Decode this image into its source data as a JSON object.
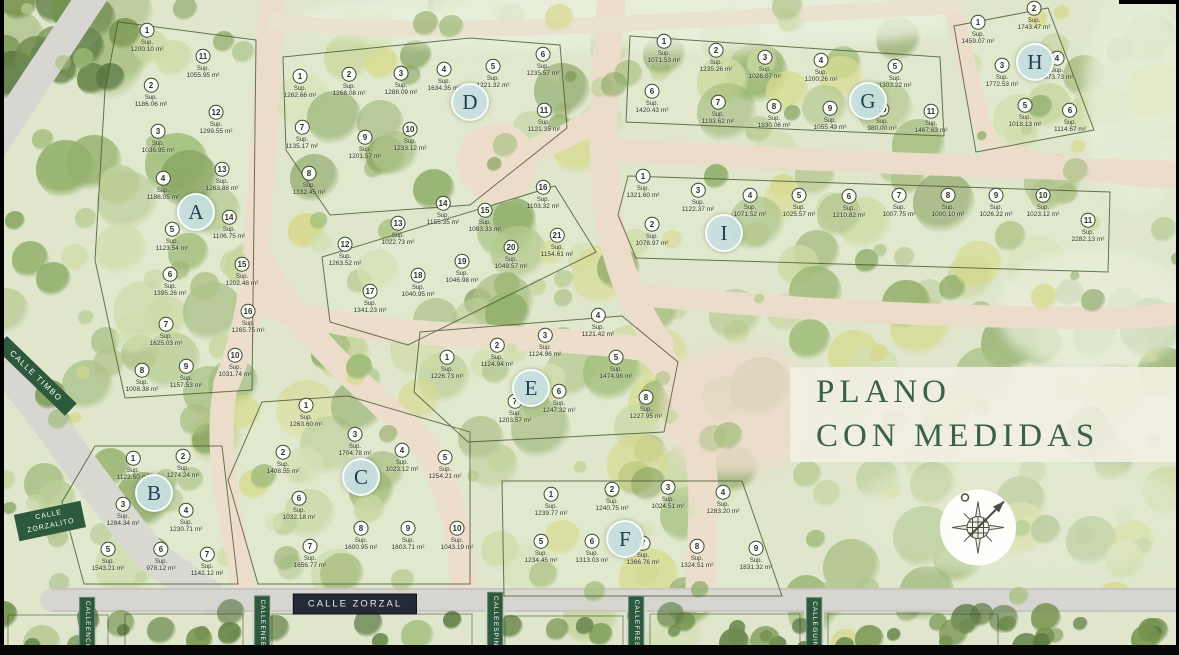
{
  "title": {
    "line1": "PLANO",
    "line2": "CON MEDIDAS"
  },
  "legend": {
    "sup_label": "Sup."
  },
  "colors": {
    "title_green": "#3c6149",
    "street_green": "#2d5a3d",
    "street_dark": "#1a212e",
    "badge_fill": "#c6deDD",
    "road_pink": "#ecdcca",
    "road_gray": "#d8d6d0",
    "forest_base": "#dfe6cc"
  },
  "compass": {
    "icon": "compass-rose"
  },
  "streets": [
    {
      "id": "calle-timbo",
      "label": "CALLE TIMBO",
      "lines": [
        "CALLE TIMBO"
      ],
      "type": "ribbon",
      "x": 36,
      "y": 376,
      "rot": 44
    },
    {
      "id": "calle-zorzalito",
      "label": "CALLE ZORZALITO",
      "lines": [
        "CALLE",
        "ZORZALITO"
      ],
      "type": "ribbon2",
      "x": 50,
      "y": 521,
      "rot": -12
    },
    {
      "id": "calle-zorzal",
      "label": "CALLE ZORZAL",
      "lines": [
        "CALLE ZORZAL"
      ],
      "type": "dark",
      "x": 355,
      "y": 604,
      "rot": 0
    },
    {
      "id": "calle-encina",
      "label": "CALLE ENCINA",
      "lines": [
        "CALLE",
        "ENCINA"
      ],
      "type": "vert",
      "x": 87,
      "y": 629,
      "rot": 0
    },
    {
      "id": "calle-enebro",
      "label": "CALLE ENEBRO",
      "lines": [
        "CALLE",
        "ENEBRO"
      ],
      "type": "vert",
      "x": 262,
      "y": 629,
      "rot": 0
    },
    {
      "id": "calle-espinillo",
      "label": "CALLE ESPINILLO",
      "lines": [
        "CALLE",
        "ESPINILLO"
      ],
      "type": "vert",
      "x": 495,
      "y": 630,
      "rot": 0
    },
    {
      "id": "calle-fresno",
      "label": "CALLE FRESNO",
      "lines": [
        "CALLE",
        "FRESNO"
      ],
      "type": "vert",
      "x": 636,
      "y": 629,
      "rot": 0
    },
    {
      "id": "calle-guindo",
      "label": "CALLE GUINDO",
      "lines": [
        "CALLE",
        "GUINDO"
      ],
      "type": "vert",
      "x": 814,
      "y": 630,
      "rot": 0
    }
  ],
  "blocks": [
    {
      "letter": "A",
      "badge": {
        "x": 196,
        "y": 212
      },
      "lots": [
        {
          "n": 1,
          "area": "1200.10 m²",
          "x": 147,
          "y": 38
        },
        {
          "n": 2,
          "area": "1186.06 m²",
          "x": 151,
          "y": 93
        },
        {
          "n": 3,
          "area": "1036.95 m²",
          "x": 158,
          "y": 139
        },
        {
          "n": 4,
          "area": "1186.05 m²",
          "x": 163,
          "y": 186
        },
        {
          "n": 5,
          "area": "1123.54 m²",
          "x": 172,
          "y": 237
        },
        {
          "n": 6,
          "area": "1395.26 m²",
          "x": 170,
          "y": 282
        },
        {
          "n": 7,
          "area": "1625.03 m²",
          "x": 166,
          "y": 332
        },
        {
          "n": 8,
          "area": "1008.38 m²",
          "x": 142,
          "y": 378
        },
        {
          "n": 9,
          "area": "1157.53 m²",
          "x": 186,
          "y": 374
        },
        {
          "n": 10,
          "area": "1031.74 m²",
          "x": 235,
          "y": 363
        },
        {
          "n": 11,
          "area": "1055.95 m²",
          "x": 203,
          "y": 64
        },
        {
          "n": 12,
          "area": "1299.55 m²",
          "x": 216,
          "y": 120
        },
        {
          "n": 13,
          "area": "1263.88 m²",
          "x": 222,
          "y": 177
        },
        {
          "n": 14,
          "area": "1106.75 m²",
          "x": 229,
          "y": 225
        },
        {
          "n": 15,
          "area": "1202.48 m²",
          "x": 242,
          "y": 272
        },
        {
          "n": 16,
          "area": "1265.75 m²",
          "x": 248,
          "y": 319
        }
      ]
    },
    {
      "letter": "B",
      "badge": {
        "x": 154,
        "y": 493
      },
      "lots": [
        {
          "n": 1,
          "area": "1122.50 m²",
          "x": 133,
          "y": 466
        },
        {
          "n": 2,
          "area": "1274.24 m²",
          "x": 183,
          "y": 464
        },
        {
          "n": 3,
          "area": "1284.34 m²",
          "x": 123,
          "y": 512
        },
        {
          "n": 4,
          "area": "1230.71 m²",
          "x": 186,
          "y": 518
        },
        {
          "n": 5,
          "area": "1543.21 m²",
          "x": 108,
          "y": 557
        },
        {
          "n": 6,
          "area": "978.12 m²",
          "x": 161,
          "y": 557
        },
        {
          "n": 7,
          "area": "1142.12 m²",
          "x": 207,
          "y": 562
        }
      ]
    },
    {
      "letter": "C",
      "badge": {
        "x": 361,
        "y": 477
      },
      "lots": [
        {
          "n": 1,
          "area": "1263.60 m²",
          "x": 306,
          "y": 413
        },
        {
          "n": 2,
          "area": "1408.55 m²",
          "x": 283,
          "y": 460
        },
        {
          "n": 3,
          "area": "1704.78 m²",
          "x": 355,
          "y": 442
        },
        {
          "n": 4,
          "area": "1023.12 m²",
          "x": 402,
          "y": 458
        },
        {
          "n": 5,
          "area": "1254.21 m²",
          "x": 445,
          "y": 465
        },
        {
          "n": 6,
          "area": "1032.18 m²",
          "x": 299,
          "y": 506
        },
        {
          "n": 7,
          "area": "1656.77 m²",
          "x": 310,
          "y": 554
        },
        {
          "n": 8,
          "area": "1600.95 m²",
          "x": 361,
          "y": 536
        },
        {
          "n": 9,
          "area": "1603.71 m²",
          "x": 408,
          "y": 536
        },
        {
          "n": 10,
          "area": "1043.19 m²",
          "x": 457,
          "y": 536
        }
      ]
    },
    {
      "letter": "D",
      "badge": {
        "x": 470,
        "y": 102
      },
      "lots": [
        {
          "n": 1,
          "area": "1262.66 m²",
          "x": 300,
          "y": 84
        },
        {
          "n": 2,
          "area": "1268.08 m²",
          "x": 349,
          "y": 82
        },
        {
          "n": 3,
          "area": "1288.09 m²",
          "x": 401,
          "y": 81
        },
        {
          "n": 4,
          "area": "1634.35 m²",
          "x": 444,
          "y": 77
        },
        {
          "n": 5,
          "area": "1221.32 m²",
          "x": 493,
          "y": 74
        },
        {
          "n": 6,
          "area": "1235.57 m²",
          "x": 543,
          "y": 62
        },
        {
          "n": 7,
          "area": "1135.17 m²",
          "x": 302,
          "y": 135
        },
        {
          "n": 8,
          "area": "1332.45 m²",
          "x": 309,
          "y": 181
        },
        {
          "n": 9,
          "area": "1201.57 m²",
          "x": 365,
          "y": 145
        },
        {
          "n": 10,
          "area": "1233.12 m²",
          "x": 410,
          "y": 137
        },
        {
          "n": 11,
          "area": "1121.35 m²",
          "x": 544,
          "y": 118
        },
        {
          "n": 12,
          "area": "1263.52 m²",
          "x": 345,
          "y": 252
        },
        {
          "n": 13,
          "area": "1022.73 m²",
          "x": 398,
          "y": 231
        },
        {
          "n": 14,
          "area": "1155.35 m²",
          "x": 443,
          "y": 211
        },
        {
          "n": 15,
          "area": "1083.33 m²",
          "x": 485,
          "y": 218
        },
        {
          "n": 16,
          "area": "1103.32 m²",
          "x": 543,
          "y": 195
        },
        {
          "n": 17,
          "area": "1341.23 m²",
          "x": 370,
          "y": 299
        },
        {
          "n": 18,
          "area": "1040.95 m²",
          "x": 418,
          "y": 283
        },
        {
          "n": 19,
          "area": "1046.98 m²",
          "x": 462,
          "y": 269
        },
        {
          "n": 20,
          "area": "1049.57 m²",
          "x": 511,
          "y": 255
        },
        {
          "n": 21,
          "area": "1154.61 m²",
          "x": 557,
          "y": 243
        }
      ]
    },
    {
      "letter": "E",
      "badge": {
        "x": 531,
        "y": 388
      },
      "lots": [
        {
          "n": 1,
          "area": "1226.73 m²",
          "x": 447,
          "y": 365
        },
        {
          "n": 2,
          "area": "1124.94 m²",
          "x": 497,
          "y": 353
        },
        {
          "n": 3,
          "area": "1124.96 m²",
          "x": 545,
          "y": 343
        },
        {
          "n": 4,
          "area": "1121.42 m²",
          "x": 598,
          "y": 323
        },
        {
          "n": 5,
          "area": "1474.98 m²",
          "x": 616,
          "y": 365
        },
        {
          "n": 6,
          "area": "1247.32 m²",
          "x": 559,
          "y": 399
        },
        {
          "n": 7,
          "area": "1203.57 m²",
          "x": 515,
          "y": 409
        },
        {
          "n": 8,
          "area": "1227.95 m²",
          "x": 646,
          "y": 405
        }
      ]
    },
    {
      "letter": "F",
      "badge": {
        "x": 625,
        "y": 539
      },
      "lots": [
        {
          "n": 1,
          "area": "1239.77 m²",
          "x": 551,
          "y": 502
        },
        {
          "n": 2,
          "area": "1240.75 m²",
          "x": 612,
          "y": 497
        },
        {
          "n": 3,
          "area": "1024.51 m²",
          "x": 668,
          "y": 495
        },
        {
          "n": 4,
          "area": "1283.20 m²",
          "x": 723,
          "y": 500
        },
        {
          "n": 5,
          "area": "1234.45 m²",
          "x": 541,
          "y": 549
        },
        {
          "n": 6,
          "area": "1313.03 m²",
          "x": 592,
          "y": 549
        },
        {
          "n": 7,
          "area": "1366.76 m²",
          "x": 643,
          "y": 551
        },
        {
          "n": 8,
          "area": "1324.51 m²",
          "x": 697,
          "y": 554
        },
        {
          "n": 9,
          "area": "1831.32 m²",
          "x": 756,
          "y": 556
        }
      ]
    },
    {
      "letter": "G",
      "badge": {
        "x": 868,
        "y": 101
      },
      "lots": [
        {
          "n": 1,
          "area": "1071.53 m²",
          "x": 664,
          "y": 49
        },
        {
          "n": 2,
          "area": "1235.26 m²",
          "x": 716,
          "y": 58
        },
        {
          "n": 3,
          "area": "1026.07 m²",
          "x": 765,
          "y": 65
        },
        {
          "n": 4,
          "area": "1200.26 m²",
          "x": 821,
          "y": 68
        },
        {
          "n": 5,
          "area": "1303.22 m²",
          "x": 895,
          "y": 74
        },
        {
          "n": 6,
          "area": "1420.43 m²",
          "x": 652,
          "y": 99
        },
        {
          "n": 7,
          "area": "1193.62 m²",
          "x": 718,
          "y": 110
        },
        {
          "n": 8,
          "area": "1930.06 m²",
          "x": 774,
          "y": 114
        },
        {
          "n": 9,
          "area": "1055.49 m²",
          "x": 830,
          "y": 116
        },
        {
          "n": 10,
          "area": "980.00 m²",
          "x": 882,
          "y": 117
        },
        {
          "n": 11,
          "area": "1467.63 m²",
          "x": 931,
          "y": 119
        }
      ]
    },
    {
      "letter": "H",
      "badge": {
        "x": 1035,
        "y": 62
      },
      "lots": [
        {
          "n": 1,
          "area": "1459.07 m²",
          "x": 978,
          "y": 30
        },
        {
          "n": 2,
          "area": "1743.47 m²",
          "x": 1034,
          "y": 16
        },
        {
          "n": 3,
          "area": "1772.53 m²",
          "x": 1002,
          "y": 73
        },
        {
          "n": 4,
          "area": "1073.73 m²",
          "x": 1057,
          "y": 66
        },
        {
          "n": 5,
          "area": "1018.13 m²",
          "x": 1025,
          "y": 113
        },
        {
          "n": 6,
          "area": "1114.67 m²",
          "x": 1070,
          "y": 118
        }
      ]
    },
    {
      "letter": "I",
      "badge": {
        "x": 724,
        "y": 233
      },
      "lots": [
        {
          "n": 1,
          "area": "1321.60 m²",
          "x": 643,
          "y": 184
        },
        {
          "n": 2,
          "area": "1078.97 m²",
          "x": 652,
          "y": 232
        },
        {
          "n": 3,
          "area": "1122.37 m²",
          "x": 698,
          "y": 198
        },
        {
          "n": 4,
          "area": "1071.52 m²",
          "x": 750,
          "y": 203
        },
        {
          "n": 5,
          "area": "1025.57 m²",
          "x": 799,
          "y": 203
        },
        {
          "n": 6,
          "area": "1210.82 m²",
          "x": 849,
          "y": 204
        },
        {
          "n": 7,
          "area": "1007.75 m²",
          "x": 899,
          "y": 203
        },
        {
          "n": 8,
          "area": "1000.10 m²",
          "x": 948,
          "y": 203
        },
        {
          "n": 9,
          "area": "1026.22 m²",
          "x": 996,
          "y": 203
        },
        {
          "n": 10,
          "area": "1023.12 m²",
          "x": 1043,
          "y": 203
        },
        {
          "n": 11,
          "area": "2282.13 m²",
          "x": 1088,
          "y": 228
        }
      ]
    }
  ]
}
